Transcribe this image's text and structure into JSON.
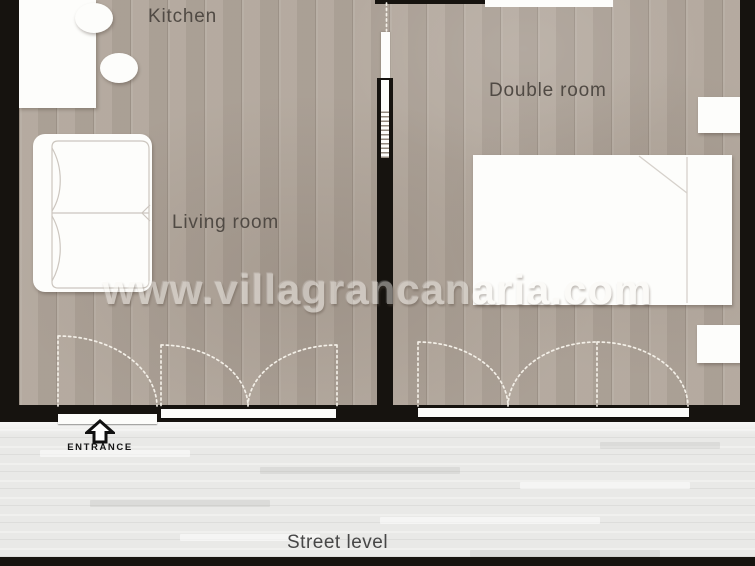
{
  "watermark": {
    "text": "www.villagrancanaria.com"
  },
  "rooms": {
    "kitchen": {
      "label": "Kitchen"
    },
    "living_room": {
      "label": "Living room"
    },
    "double_room": {
      "label": "Double room"
    }
  },
  "annotations": {
    "entrance": {
      "label": "ENTRANCE"
    },
    "street_level": {
      "label": "Street level"
    }
  },
  "colors": {
    "wall": "#16130f",
    "floor": "#b1a69b",
    "street": "#e9e9e7",
    "furniture": "#fdfdfb",
    "label": "#504a44",
    "dash": "#f3efe7",
    "watermark": "#faf8f4"
  }
}
